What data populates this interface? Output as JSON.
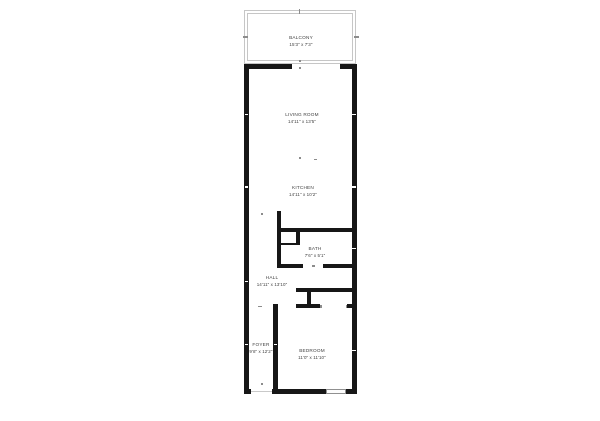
{
  "title": "Apartment floor plan",
  "colors": {
    "background": "#ffffff",
    "wall": "#171717",
    "balcony_line": "#c6c6c6",
    "text": "#414141",
    "mark": "#8c8c8c",
    "window_border": "#909090",
    "entry_line": "#c9c9c9"
  },
  "plan": {
    "rooms": [
      {
        "id": "balcony",
        "name": "BALCONY",
        "dims": "15'3\" x 7'3\"",
        "cx": 301,
        "top": 35
      },
      {
        "id": "living-room",
        "name": "LIVING ROOM",
        "dims": "14'11\" x 13'5\"",
        "cx": 302,
        "top": 111.5
      },
      {
        "id": "kitchen",
        "name": "KITCHEN",
        "dims": "14'11\" x 10'2\"",
        "cx": 303,
        "top": 184.5
      },
      {
        "id": "bath",
        "name": "BATH",
        "dims": "7'6\" x 5'1\"",
        "cx": 315,
        "top": 245.5
      },
      {
        "id": "hall",
        "name": "HALL",
        "dims": "14'11\" x 13'10\"",
        "cx": 272,
        "top": 274.5
      },
      {
        "id": "foyer",
        "name": "FOYER",
        "dims": "9'8\" x 12'2\"",
        "cx": 261,
        "top": 342
      },
      {
        "id": "bedroom",
        "name": "BEDROOM",
        "dims": "11'0\" x 11'10\"",
        "cx": 312,
        "top": 347.5
      }
    ],
    "balcony_outline": [
      {
        "x": 244,
        "y": 10,
        "w": 112,
        "h": 54
      },
      {
        "x": 247,
        "y": 13,
        "w": 106,
        "h": 48
      }
    ],
    "walls": [
      {
        "id": "living-top-left",
        "x": 244,
        "y": 64,
        "w": 48,
        "h": 5
      },
      {
        "id": "living-top-right",
        "x": 340,
        "y": 64,
        "w": 17,
        "h": 5
      },
      {
        "id": "left-wall",
        "x": 244,
        "y": 64,
        "w": 5,
        "h": 330
      },
      {
        "id": "right-wall",
        "x": 352,
        "y": 64,
        "w": 5,
        "h": 330
      },
      {
        "id": "bottom-left-stub",
        "x": 244,
        "y": 389,
        "w": 7,
        "h": 5
      },
      {
        "id": "bottom-mid",
        "x": 272,
        "y": 389,
        "w": 54,
        "h": 5
      },
      {
        "id": "bottom-right",
        "x": 346,
        "y": 389,
        "w": 11,
        "h": 5
      },
      {
        "id": "kitchen-bath-stub",
        "x": 277,
        "y": 211,
        "w": 4,
        "h": 57
      },
      {
        "id": "bath-top",
        "x": 277,
        "y": 228,
        "w": 80,
        "h": 4
      },
      {
        "id": "bath-closet-divider",
        "x": 296,
        "y": 228,
        "w": 4,
        "h": 17
      },
      {
        "id": "closet-thin-wall",
        "x": 277,
        "y": 243,
        "w": 23,
        "h": 2
      },
      {
        "id": "bath-bottom-left",
        "x": 277,
        "y": 264,
        "w": 26,
        "h": 4
      },
      {
        "id": "bath-bottom-right",
        "x": 323,
        "y": 264,
        "w": 34,
        "h": 4
      },
      {
        "id": "hall-closet-top",
        "x": 296,
        "y": 288,
        "w": 61,
        "h": 4
      },
      {
        "id": "closet-stub",
        "x": 307,
        "y": 292,
        "w": 4,
        "h": 16
      },
      {
        "id": "bedroom-top-left",
        "x": 296,
        "y": 304,
        "w": 24,
        "h": 4
      },
      {
        "id": "bedroom-top-right",
        "x": 347,
        "y": 304,
        "w": 10,
        "h": 4
      },
      {
        "id": "foyer-bedroom-divider",
        "x": 273,
        "y": 304,
        "w": 5,
        "h": 90
      }
    ],
    "marks": [
      {
        "id": "balcony-top-tick",
        "x": 298.5,
        "y": 8.5,
        "w": 1.5,
        "h": 5
      },
      {
        "id": "balcony-left-tick",
        "x": 243,
        "y": 36,
        "w": 5,
        "h": 1.5
      },
      {
        "id": "balcony-right-tick",
        "x": 354,
        "y": 36,
        "w": 5,
        "h": 1.5
      },
      {
        "id": "balcony-door-dot-1",
        "x": 299,
        "y": 60,
        "w": 2,
        "h": 2
      },
      {
        "id": "balcony-door-dot-2",
        "x": 299,
        "y": 66.5,
        "w": 2,
        "h": 2
      },
      {
        "id": "kitchen-dot-1",
        "x": 299,
        "y": 156.5,
        "w": 2,
        "h": 2
      },
      {
        "id": "kitchen-dash",
        "x": 313.5,
        "y": 158.5,
        "w": 3.5,
        "h": 1.5
      },
      {
        "id": "hall-dot",
        "x": 260.5,
        "y": 212.5,
        "w": 2,
        "h": 2
      },
      {
        "id": "bath-door-dash",
        "x": 312,
        "y": 265,
        "w": 3,
        "h": 1.5
      },
      {
        "id": "closet-opening-tick-1",
        "x": 320,
        "y": 305,
        "w": 1.5,
        "h": 3
      },
      {
        "id": "closet-opening-tick-2",
        "x": 345.5,
        "y": 305,
        "w": 1.5,
        "h": 3
      },
      {
        "id": "foyer-corner-mark",
        "x": 257.5,
        "y": 305.5,
        "w": 4,
        "h": 1.2
      },
      {
        "id": "entry-tick",
        "x": 261,
        "y": 382.5,
        "w": 2,
        "h": 2
      }
    ],
    "notches": [
      {
        "x": 244.8,
        "y": 113.8
      },
      {
        "x": 352.4,
        "y": 113.8
      },
      {
        "x": 244.8,
        "y": 186.2
      },
      {
        "x": 352.4,
        "y": 186.2
      },
      {
        "x": 244.8,
        "y": 280.6
      },
      {
        "x": 352.4,
        "y": 247.6
      },
      {
        "x": 244.8,
        "y": 344.0
      },
      {
        "x": 274.0,
        "y": 344.0
      },
      {
        "x": 352.4,
        "y": 349.6
      }
    ],
    "window": {
      "x": 326,
      "y": 389.3,
      "w": 20,
      "h": 4.4
    },
    "entry_line": {
      "x": 251,
      "y": 390.6,
      "w": 21,
      "h": 1.2
    }
  }
}
